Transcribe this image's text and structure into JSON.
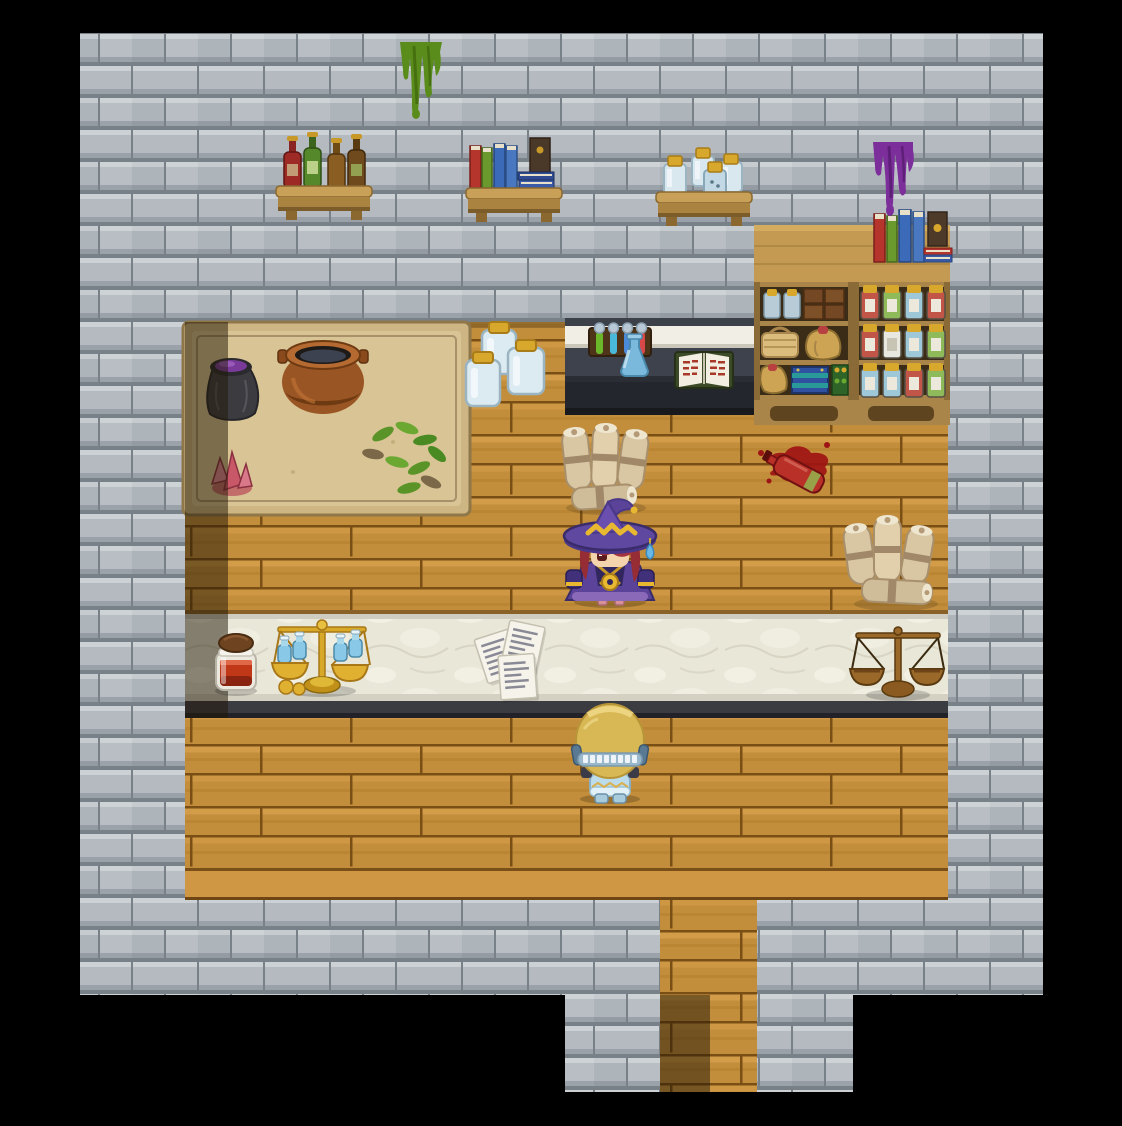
{
  "scene": {
    "title": "Alchemist shop interior (RPG tile map)",
    "canvas": {
      "width": 1122,
      "height": 1126,
      "background": "#000000"
    },
    "hud_text": "none visible",
    "palette": {
      "letterbox": "#000000",
      "wall_brick": "#b4bac0",
      "wall_mortar": "#788088",
      "floor_wood": "#c28e3c",
      "floor_shadow": "#201504",
      "counter_marble": "#e9e7d8",
      "counter_front": "#3b3b42",
      "workbench_mat": "#d9c495",
      "station_body": "#3d424c",
      "accent_gold": "#d8a82c",
      "slime_green": "#5a8c1c",
      "slime_purple": "#7c2e9a",
      "witch_robe": "#5a4398",
      "witch_hair": "#a23440",
      "customer_hair": "#d8b855",
      "potion_red": "#c03818",
      "potion_blue": "#8ac8e8"
    },
    "sprites": {
      "green_drip": {
        "label": "green slime drip on wall",
        "transform": "translate(398,42)"
      },
      "purple_drip": {
        "label": "purple slime drip on wall",
        "transform": "translate(869,142)"
      },
      "shelf_bottles": {
        "label": "wall shelf with four bottles",
        "transform": "translate(276,128)"
      },
      "shelf_books": {
        "label": "wall shelf with books",
        "transform": "translate(466,136)"
      },
      "shelf_jars": {
        "label": "wall shelf with lidded jars",
        "transform": "translate(656,144)"
      },
      "cabinet_left": {
        "label": "storage cabinet with crates and sacks",
        "transform": "translate(754,225)"
      },
      "cabinet_right": {
        "label": "storage cabinet with potion jars",
        "transform": "translate(853,225)"
      },
      "cabinet_books": {
        "label": "books stacked on cabinet top",
        "transform": "translate(874,206)"
      },
      "workbench": {
        "label": "workbench mat with cauldron",
        "transform": "translate(183,322)"
      },
      "floor_jars": {
        "label": "three glass jars",
        "transform": "translate(464,316)"
      },
      "station": {
        "label": "alchemy station with tubes and book",
        "transform": "translate(565,318)"
      },
      "scrolls_upper": {
        "label": "bundle of scrolls",
        "transform": "translate(560,424)"
      },
      "spill": {
        "label": "spilled red potion bottle",
        "transform": "translate(755,433)"
      },
      "scrolls_right": {
        "label": "bundle of scrolls",
        "transform": "translate(846,514)"
      },
      "witch": {
        "label": "witch player character",
        "transform": "translate(558,500)"
      },
      "potion_counter": {
        "label": "red potion jar on counter",
        "transform": "translate(212,634)"
      },
      "scale_gold": {
        "label": "golden balance scale with blue vials",
        "transform": "translate(270,613)"
      },
      "papers": {
        "label": "loose handwritten papers",
        "transform": "translate(468,618)"
      },
      "scale_bronze": {
        "label": "bronze balance scale",
        "transform": "translate(850,623)"
      },
      "customer": {
        "label": "blonde customer NPC at counter",
        "transform": "translate(566,701)"
      }
    }
  }
}
